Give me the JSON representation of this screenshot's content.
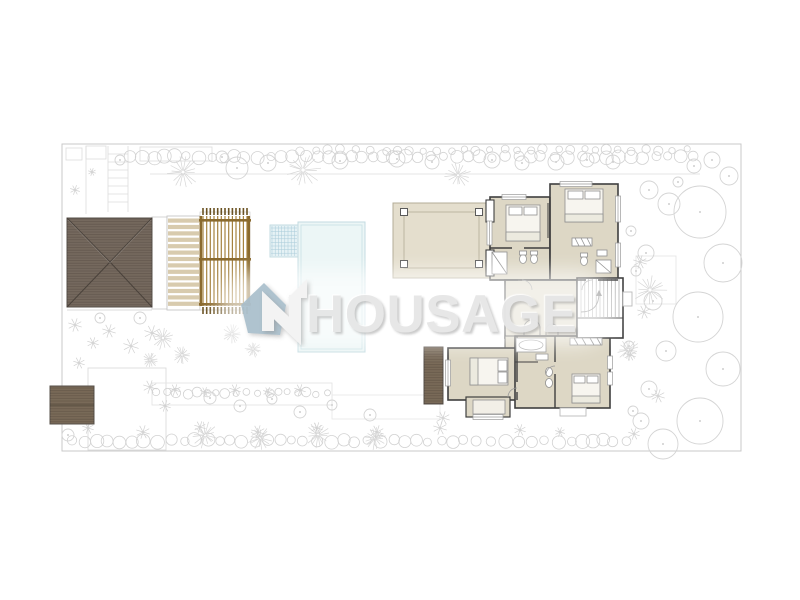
{
  "watermark": {
    "text": "HOUSAGE"
  },
  "palette": {
    "roof_brown": "#75695e",
    "shed_brown": "#796a58",
    "pergola_wood": "#a5823f",
    "pergola_frame": "#8a6a2e",
    "pergola_tick": "#6b5323",
    "deck_board": "#d8cbae",
    "room_beige": "#ddd7c5",
    "terrace_beige": "#e4decd",
    "pool_blue": "#ecf6f6",
    "spa_grid_blue": "#a8cbd9",
    "wall_dark": "#3f3f3f",
    "garden_line": "#d4d4d4",
    "watermark_gray": "#e6e6e6",
    "logo_house_blue": "#a7bdca",
    "logo_arrow_white": "#f3f3f3"
  },
  "plan": {
    "elements": [
      "site-boundary",
      "hedge-top",
      "hedge-bottom",
      "trees-right",
      "garden-plants",
      "driveway-steps",
      "garage-hip-roof",
      "side-deck",
      "board-deck",
      "wooden-pergola",
      "swimming-pool",
      "spa-steps",
      "canopy-terrace",
      "upper-floor-plan",
      "bedroom-upper-left",
      "bedroom-upper-right",
      "bedroom-lower-left",
      "bedroom-lower-right",
      "bathrooms",
      "hall",
      "staircase",
      "entry-vestibule",
      "bay-terrace",
      "shed-roof",
      "watermark-logo",
      "watermark-text"
    ]
  }
}
